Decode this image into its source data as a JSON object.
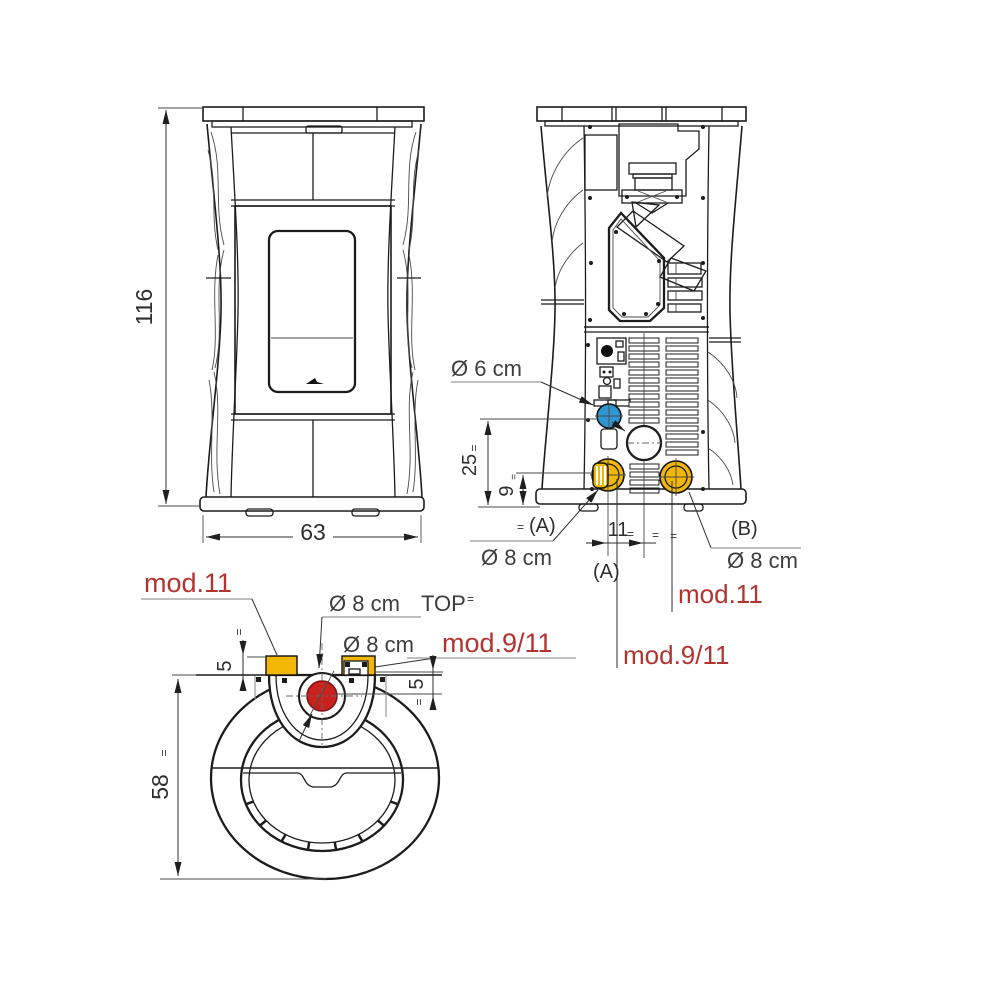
{
  "colors": {
    "blue": "#2e96d1",
    "yellow": "#f2b705",
    "red": "#c9211e",
    "red_text": "#b23430",
    "leader_gray": "#999999"
  },
  "eq": "=",
  "front_view": {
    "height_cm": "116",
    "width_cm": "63"
  },
  "rear_view": {
    "flue_diameter": "Ø 6 cm",
    "dim_flue_height": "25",
    "dim_air_height": "9",
    "dim_flue_offset": "11",
    "outlet_a": "(A)",
    "outlet_a2": "(A)",
    "outlet_b": "(B)",
    "outlet_a_diameter": "Ø 8 cm",
    "outlet_b_diameter": "Ø 8 cm",
    "model_11": "mod.11",
    "model_9_11": "mod.9/11"
  },
  "top_view": {
    "model_11": "mod.11",
    "top_flue_diameter": "Ø 8 cm",
    "top_flue_tag": "TOP",
    "rear_outlet_diameter": "Ø 8 cm",
    "model_9_11": "mod.9/11",
    "dim_cap_height": "5",
    "dim_flue_depth": "5",
    "depth_cm": "58"
  }
}
